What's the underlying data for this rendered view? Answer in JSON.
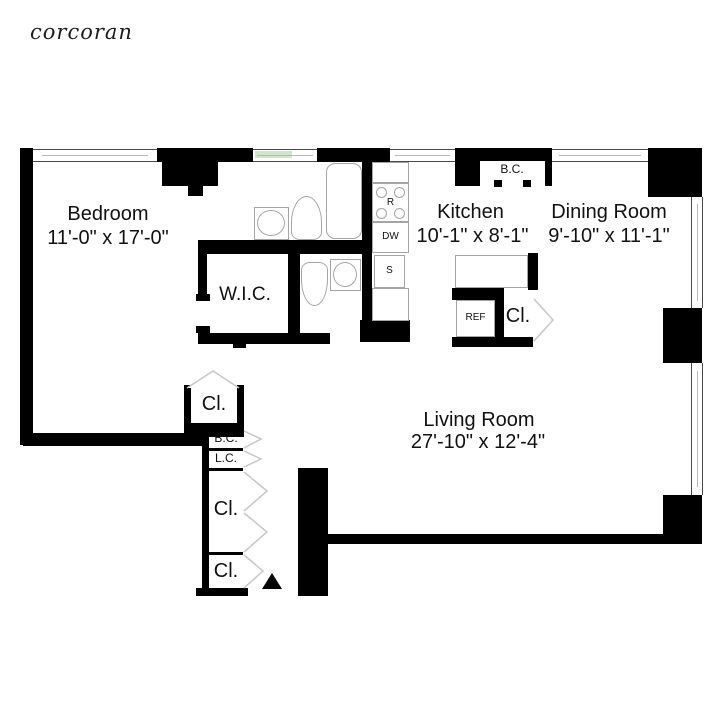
{
  "brand": {
    "logo_text": "corcoran"
  },
  "colors": {
    "wall": "#000000",
    "fixture_outline": "#a5a5a5",
    "door_swing": "#c6c6c6",
    "window_tint": "#cde7c8"
  },
  "rooms": {
    "bedroom": {
      "name": "Bedroom",
      "dimensions": "11'-0\" x 17'-0\""
    },
    "kitchen": {
      "name": "Kitchen",
      "dimensions": "10'-1\" x 8'-1\""
    },
    "dining_room": {
      "name": "Dining Room",
      "dimensions": "9'-10\" x 11'-1\""
    },
    "living_room": {
      "name": "Living Room",
      "dimensions": "27'-10\" x 12'-4\""
    },
    "walk_in_closet": {
      "name": "W.I.C."
    }
  },
  "closets": {
    "broom_closet_kitchen": "B.C.",
    "closet_dining": "Cl.",
    "closet_bedroom": "Cl.",
    "broom_closet_hall": "B.C.",
    "linen_closet_hall": "L.C.",
    "closet_hall_large": "Cl.",
    "closet_hall_entry": "Cl."
  },
  "appliances": {
    "range": "R",
    "dishwasher": "DW",
    "sink": "S",
    "refrigerator": "REF"
  }
}
